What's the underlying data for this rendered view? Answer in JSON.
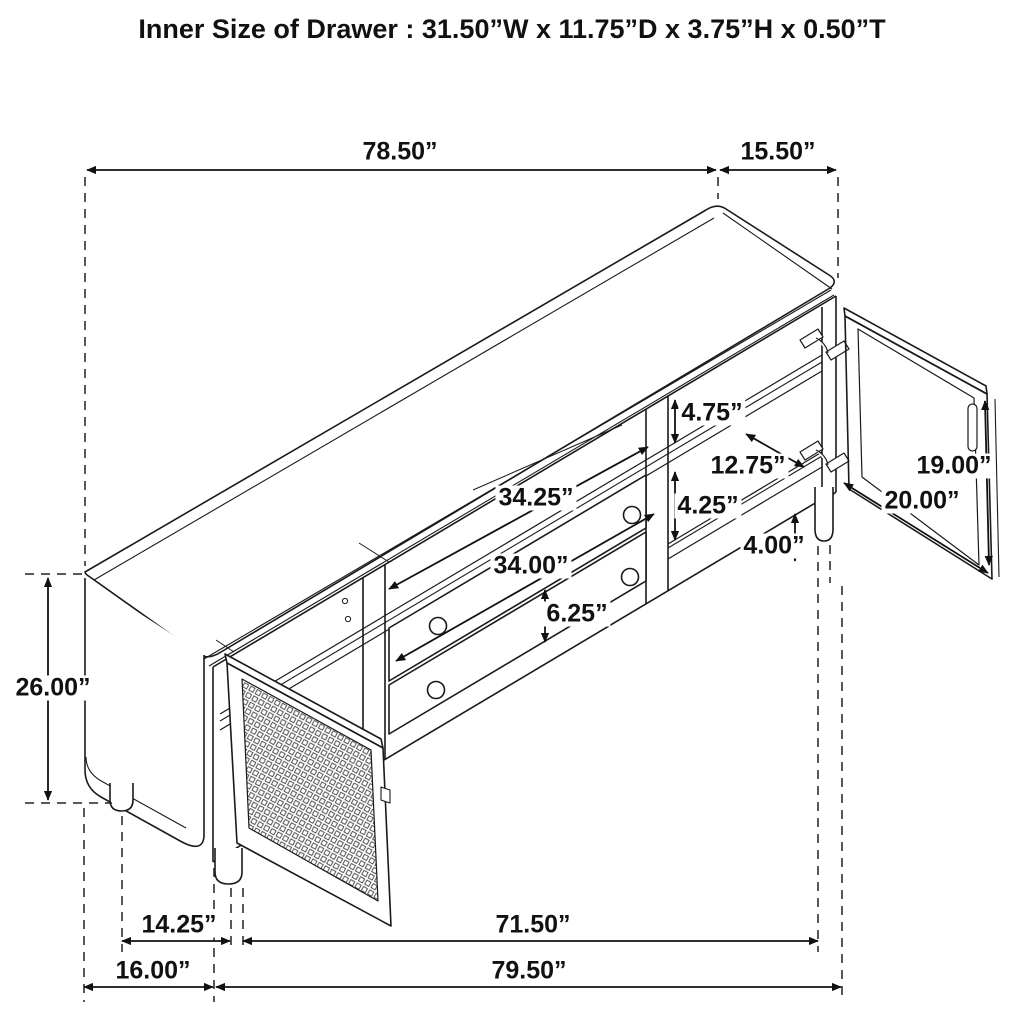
{
  "title": "Inner Size of Drawer : 31.50”W x 11.75”D x 3.75”H x 0.50”T",
  "diagram": {
    "type": "furniture-dimension-line-drawing",
    "subject": "TV console sideboard with cane mesh door, glass door and two drawers, shown in 3/4 view with dimension arrows",
    "units": "inches",
    "colors": {
      "line": "#1a1a1a",
      "background": "#ffffff"
    },
    "dimensions": [
      {
        "id": "top-width",
        "label": "78.50”",
        "value": 78.5,
        "x": 400,
        "y": 152
      },
      {
        "id": "top-depth",
        "label": "15.50”",
        "value": 15.5,
        "x": 778,
        "y": 152
      },
      {
        "id": "overall-height",
        "label": "26.00”",
        "value": 26.0,
        "x": 53,
        "y": 688
      },
      {
        "id": "upper-shelf-height",
        "label": "4.75”",
        "value": 4.75,
        "x": 712,
        "y": 413
      },
      {
        "id": "shelf-depth",
        "label": "12.75”",
        "value": 12.75,
        "x": 748,
        "y": 466
      },
      {
        "id": "middle-shelf-height",
        "label": "4.25”",
        "value": 4.25,
        "x": 708,
        "y": 506
      },
      {
        "id": "floor-clearance",
        "label": "4.00”",
        "value": 4.0,
        "x": 774,
        "y": 546
      },
      {
        "id": "door-height",
        "label": "19.00”",
        "value": 19.0,
        "x": 954,
        "y": 466
      },
      {
        "id": "door-width",
        "label": "20.00”",
        "value": 20.0,
        "x": 922,
        "y": 501
      },
      {
        "id": "upper-opening-width",
        "label": "34.25”",
        "value": 34.25,
        "x": 536,
        "y": 498
      },
      {
        "id": "drawer-front-width",
        "label": "34.00”",
        "value": 34.0,
        "x": 531,
        "y": 566
      },
      {
        "id": "drawer-front-height",
        "label": "6.25”",
        "value": 6.25,
        "x": 577,
        "y": 614
      },
      {
        "id": "leg-inset",
        "label": "14.25”",
        "value": 14.25,
        "x": 179,
        "y": 925
      },
      {
        "id": "leg-span",
        "label": "71.50”",
        "value": 71.5,
        "x": 533,
        "y": 925
      },
      {
        "id": "end-overhang",
        "label": "16.00”",
        "value": 16.0,
        "x": 153,
        "y": 971
      },
      {
        "id": "overall-length",
        "label": "79.50”",
        "value": 79.5,
        "x": 529,
        "y": 971
      }
    ]
  }
}
